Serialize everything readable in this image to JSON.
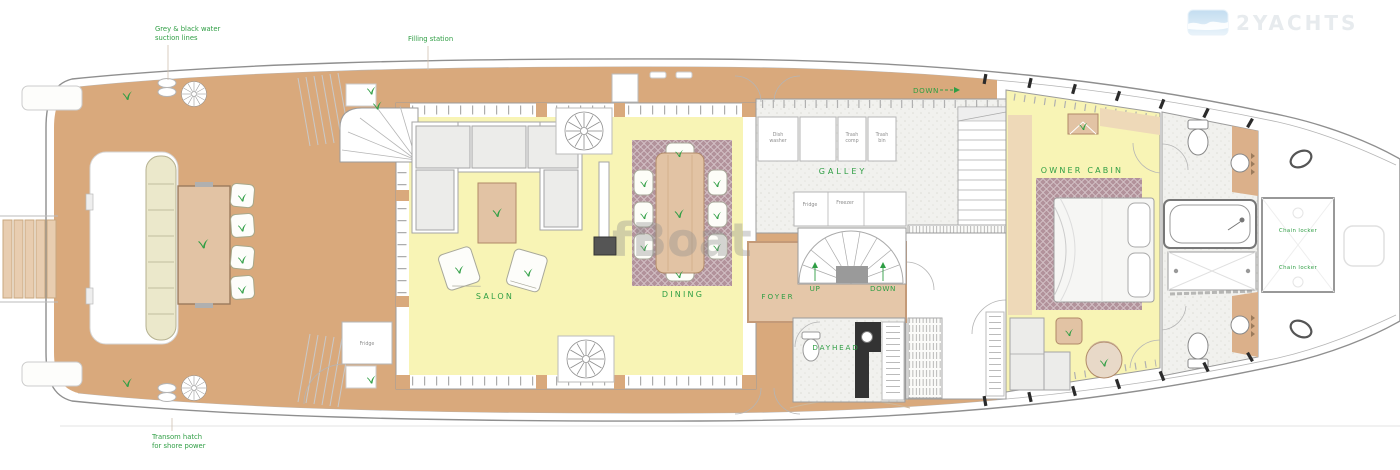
{
  "plan_title": "yacht-main-deck-floor-plan",
  "logo": {
    "brand": "2YACHTS"
  },
  "watermark": "fBoat",
  "notes": {
    "suction": [
      "Grey & black water",
      "suction lines"
    ],
    "filling_station": "Filling station",
    "transom": [
      "Transom hatch",
      "for shore power"
    ]
  },
  "rooms": {
    "salon": "SALON",
    "dining": "DINING",
    "galley": "GALLEY",
    "foyer": "FOYER",
    "dayhead": "DAYHEAD",
    "owner_cabin": "OWNER CABIN",
    "chain_locker_upper": "Chain locker",
    "chain_locker_lower": "Chain locker"
  },
  "stairs": {
    "galley_down": "DOWN",
    "foyer_up": "UP",
    "foyer_down": "DOWN"
  },
  "equipment": {
    "dish_washer": [
      "Dish",
      "washer"
    ],
    "trash_comp": [
      "Trash",
      "comp"
    ],
    "trash_bin": [
      "Trash",
      "bin"
    ],
    "fridge": "Fridge",
    "freezer": "Freezer",
    "salon_fridge": "Fridge"
  },
  "colors": {
    "deck_teak": "#d9a97c",
    "interior_floor": "#f8f4b5",
    "carpet_mauve": "#b2929b",
    "foyer_tan": "#e5c7a9",
    "tile_gray": "#f1f1ee",
    "bench_cream": "#ebe8cb",
    "furniture_tan": "#e2c3a4",
    "label_green": "#2f9e44"
  }
}
